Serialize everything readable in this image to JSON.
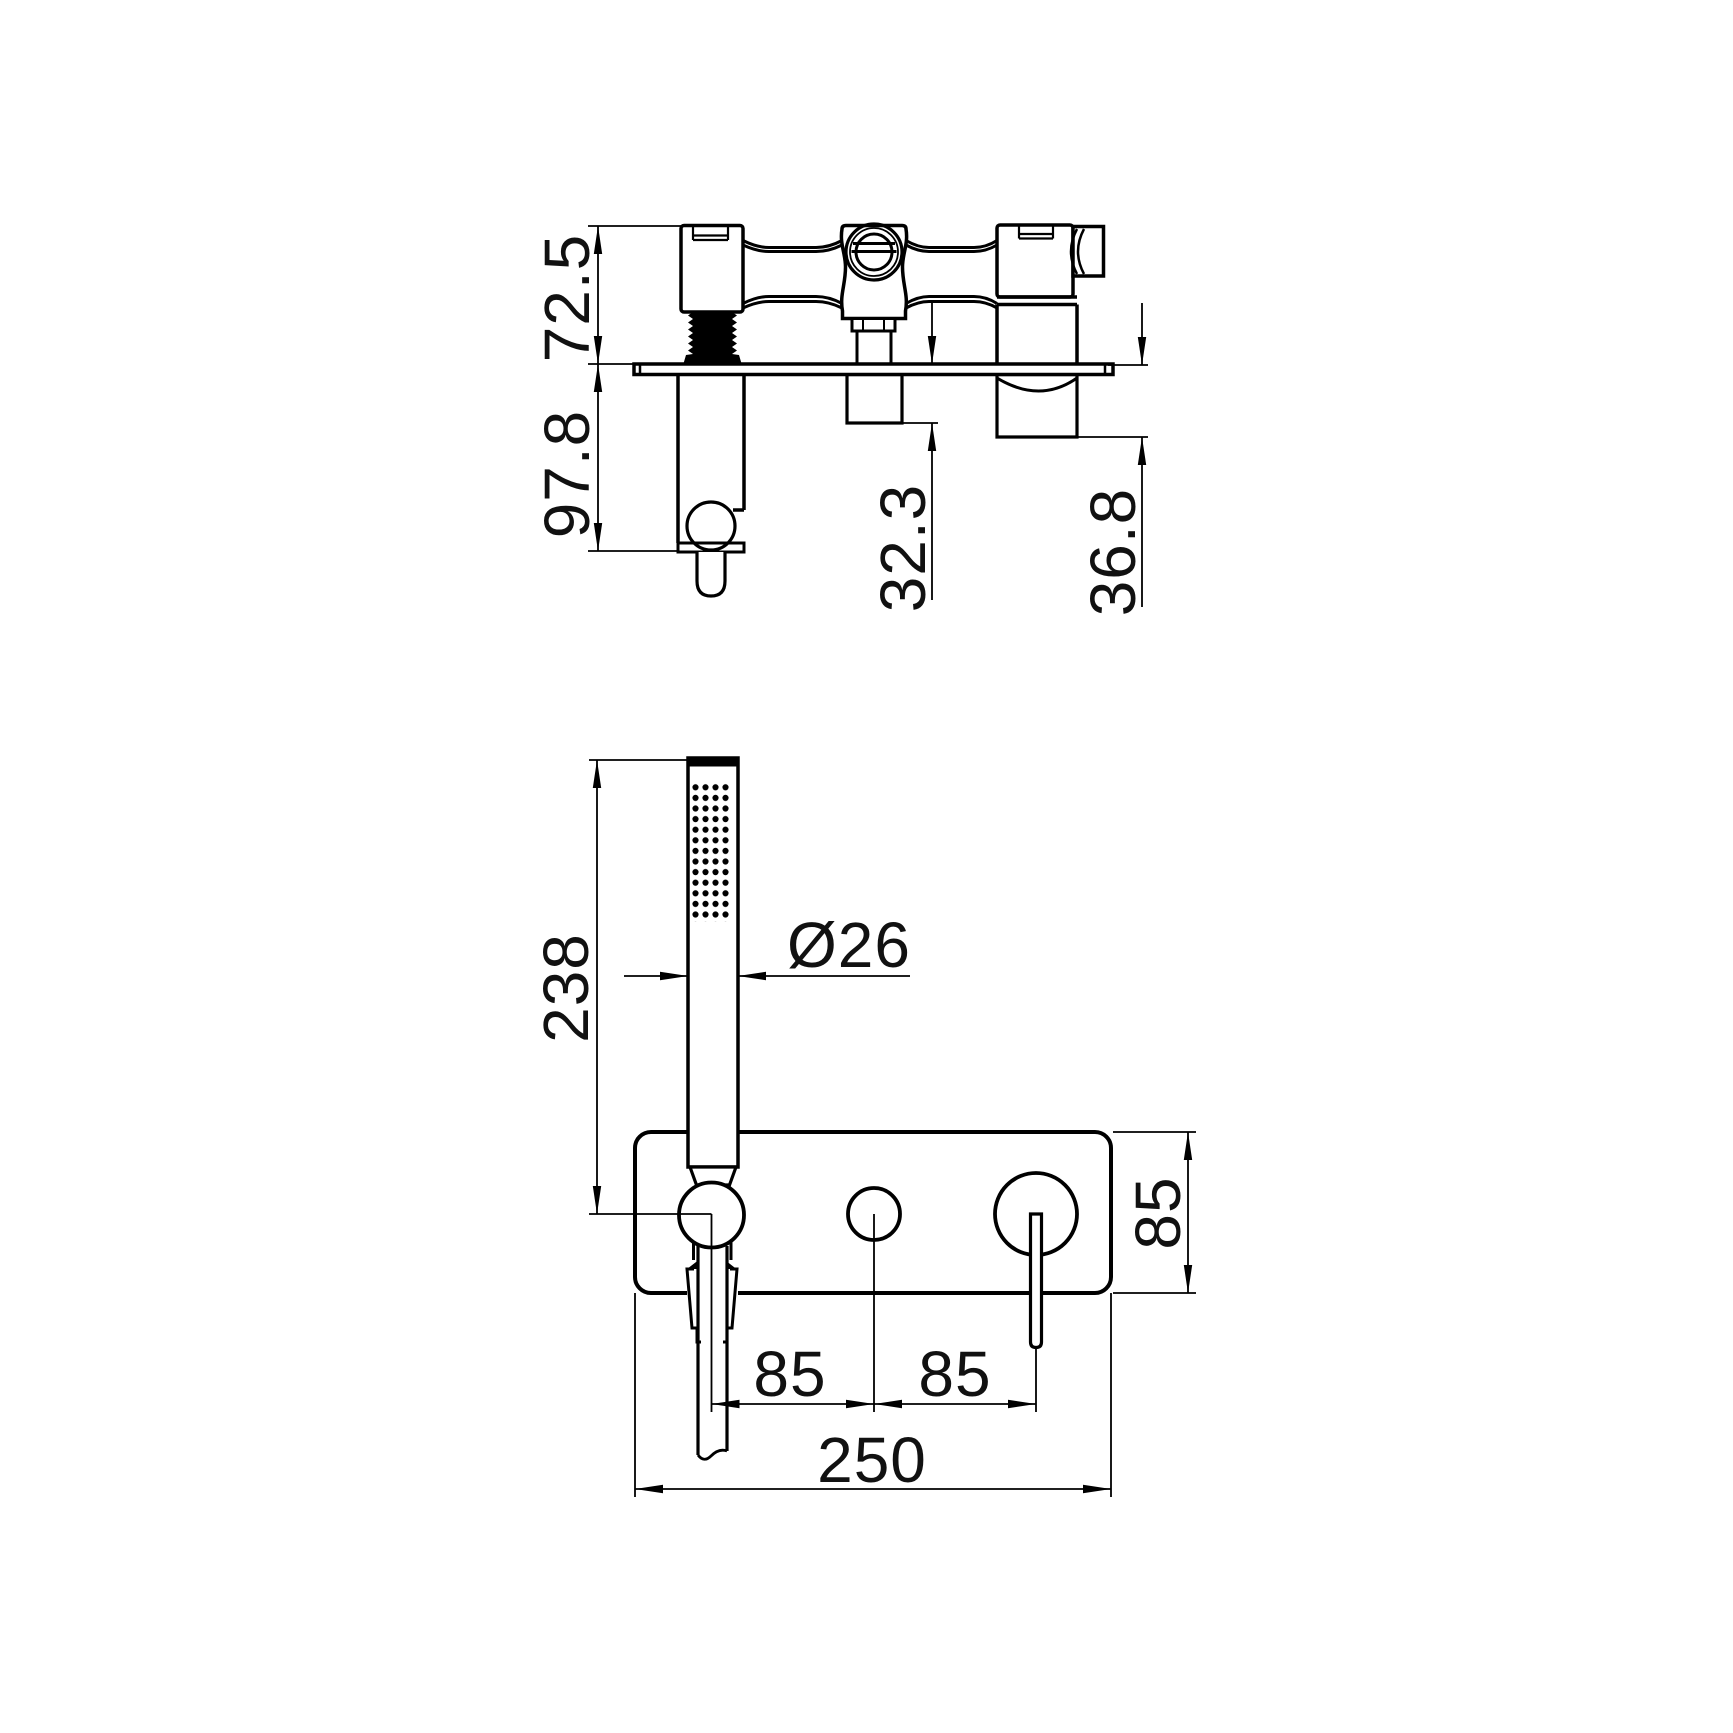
{
  "page": {
    "background": "#ffffff",
    "line_color": "#000000"
  },
  "side_view": {
    "dims": {
      "above_plate": "72.5",
      "below_plate": "97.8",
      "outlet_projection": "32.3",
      "handle_projection": "36.8"
    }
  },
  "front_view": {
    "dims": {
      "handset_length": "238",
      "handset_diameter": "Ø26",
      "spacing_left": "85",
      "spacing_right": "85",
      "plate_height": "85",
      "plate_width": "250"
    }
  }
}
